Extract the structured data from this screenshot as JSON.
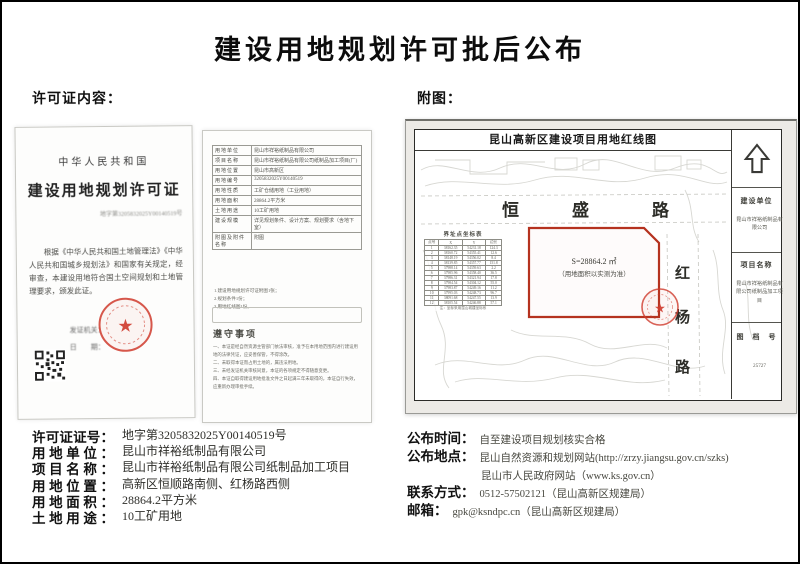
{
  "page": {
    "title": "建设用地规划许可批后公布",
    "permit_section_label": "许可证内容：",
    "map_section_label": "附图："
  },
  "permit": {
    "country": "中华人民共和国",
    "cert_title": "建设用地规划许可证",
    "cert_no_line": "地字第3205832025Y00140519号",
    "body_text": "根据《中华人民共和国土地管理法》《中华人民共和国城乡规划法》和国家有关规定，经审查，本建设用地符合国土空间规划和土地管理要求，颁发此证。",
    "issuer_label": "发证机关：",
    "date_label": "日　　期：",
    "page2": {
      "table_rows": [
        {
          "label": "用地单位",
          "value": "昆山市祥裕纸制品有限公司"
        },
        {
          "label": "项目名称",
          "value": "昆山市祥裕纸制品有限公司纸制品加工项目(厂)"
        },
        {
          "label": "用地位置",
          "value": "昆山市高新区"
        },
        {
          "label": "用地编号",
          "value": "3205832025Y00140519"
        },
        {
          "label": "用地性质",
          "value": "工矿仓储用地（工业用地）"
        },
        {
          "label": "用地面积",
          "value": "28864.2平方米"
        },
        {
          "label": "土地用途",
          "value": "10工矿用地"
        },
        {
          "label": "建设规模",
          "value": "详见规划条件、设计方案、规划要求（含地下室）"
        },
        {
          "label": "附图及附件名称",
          "value": "附图"
        }
      ],
      "attachment_lines": [
        "1.建设用地规划许可证附图1张；",
        "2.规划条件1份；",
        "3.用地红线图1份。"
      ],
      "notice_title": "遵守事项",
      "notice_items": [
        "一、本证是经自然资源主管部门依法审核，准予在本用地范围内进行建设用地的法律凭证，应妥善保管，不得涂改。",
        "二、未取得本证而占用土地的，属违法用地。",
        "三、未经发证机关审核同意，本证的各项规定不得随意变更。",
        "四、本证自取得建设用地批准文件之日起满三年未取得的，本证自行失效，应重新办理审批手续。"
      ]
    }
  },
  "map": {
    "title": "昆山高新区建设项目用地红线图",
    "road_horizontal": {
      "c1": "恒",
      "c2": "盛",
      "c3": "路"
    },
    "road_vertical": {
      "c1": "红",
      "c2": "杨",
      "c3": "路"
    },
    "parcel_area_label": "S=28864.2 ㎡",
    "parcel_note": "（用地面积以实测为准）",
    "coord_table": {
      "title": "界址点坐标表",
      "headers": [
        "点号",
        "X",
        "Y",
        "边长"
      ],
      "rows": [
        [
          "1",
          "38162.35",
          "54231.18",
          "124.3"
        ],
        [
          "2",
          "38160.72",
          "54355.41",
          "12.6"
        ],
        [
          "3",
          "38148.19",
          "54356.02",
          "8.4"
        ],
        [
          "4",
          "38139.85",
          "54357.77",
          "151.8"
        ],
        [
          "5",
          "37988.14",
          "54359.63",
          "2.2"
        ],
        [
          "6",
          "37985.96",
          "54358.40",
          "36.5"
        ],
        [
          "7",
          "37986.31",
          "54321.94",
          "17.8"
        ],
        [
          "8",
          "37984.54",
          "54304.12",
          "55.0"
        ],
        [
          "9",
          "37983.87",
          "54249.16",
          "11.2"
        ],
        [
          "10",
          "37995.03",
          "54248.73",
          "96.7"
        ],
        [
          "11",
          "38091.68",
          "54247.55",
          "13.9"
        ],
        [
          "12",
          "38105.54",
          "54246.88",
          "57.1"
        ]
      ],
      "footnote": "注：坐标采用昆山城建坐标系"
    },
    "titleblock": {
      "builder_label": "建设单位",
      "builder_value": "昆山市祥裕纸制品有限公司",
      "project_label": "项目名称",
      "project_value": "昆山市祥裕纸制品有限公司纸制品加工项目",
      "figno_label": "图　档　号",
      "figno_value": "25727"
    }
  },
  "details": {
    "items": [
      {
        "label": "许可证证号：",
        "value": "地字第3205832025Y00140519号"
      },
      {
        "label": "用地单位：",
        "value": "昆山市祥裕纸制品有限公司"
      },
      {
        "label": "项目名称：",
        "value": "昆山市祥裕纸制品有限公司纸制品加工项目"
      },
      {
        "label": "用地位置：",
        "value": "高新区恒顺路南侧、红杨路西侧"
      },
      {
        "label": "用地面积：",
        "value": "28864.2平方米"
      },
      {
        "label": "土地用途：",
        "value": "10工矿用地"
      }
    ]
  },
  "publish": {
    "time_label": "公布时间：",
    "time_value": "自至建设项目规划核实合格",
    "place_label": "公布地点：",
    "place_value_1": "昆山自然资源和规划网站(http://zrzy.jiangsu.gov.cn/szks)",
    "place_value_2": "昆山市人民政府网站（www.ks.gov.cn）",
    "contact_label": "联系方式：",
    "contact_value": "0512-57502121（昆山高新区规建局）",
    "email_label": "邮箱：",
    "email_value": "gpk@ksndpc.cn（昆山高新区规建局）"
  }
}
